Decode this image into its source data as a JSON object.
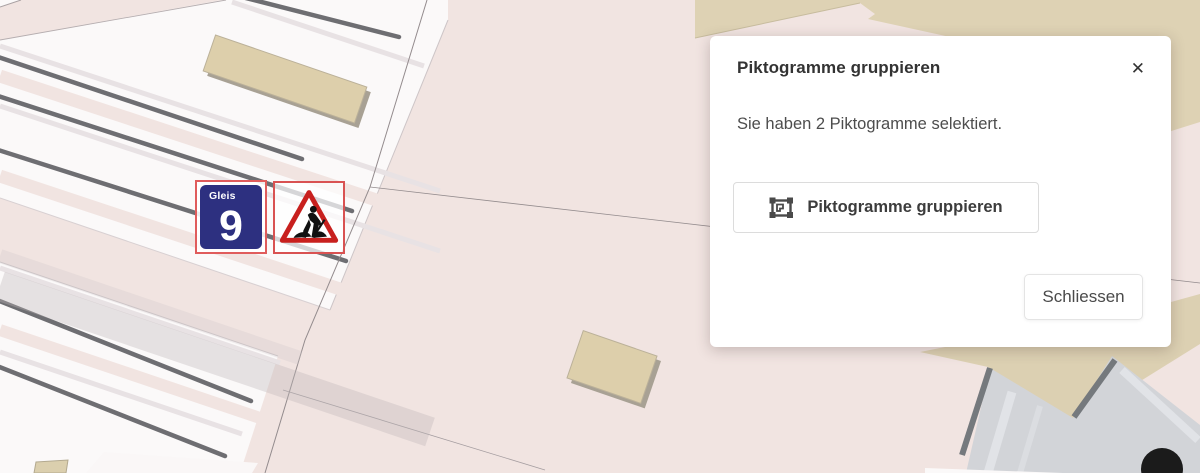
{
  "map": {
    "selection_color": "#e05c5c",
    "pictograms": [
      {
        "type": "track-sign",
        "label": "Gleis",
        "number": "9"
      },
      {
        "type": "roadworks-sign"
      }
    ]
  },
  "dialog": {
    "title": "Piktogramme gruppieren",
    "close_icon": "✕",
    "body_text": "Sie haben 2 Piktogramme selektiert.",
    "group_button_label": "Piktogramme gruppieren",
    "close_button_label": "Schliessen"
  }
}
